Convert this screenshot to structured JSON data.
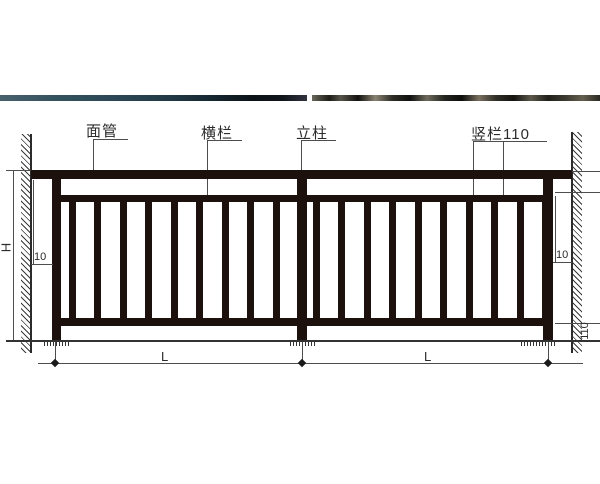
{
  "drawing": {
    "title": "railing elevation drawing",
    "labels": {
      "top_rail": "面管",
      "horizontal_rail": "横栏",
      "post": "立柱",
      "vertical_bar": "竖栏110"
    },
    "dimensions": {
      "overall_height": "H",
      "wall_gap_left": "10",
      "wall_gap_right": "10",
      "bottom_clearance": "110",
      "span_left": "L",
      "span_right": "L"
    },
    "colors": {
      "steel": "#1c110c",
      "line": "#4d4d4d",
      "text": "#2b2b2b",
      "photo_strip_left": "#2b4755",
      "photo_strip_right": "#4a4a3f"
    }
  }
}
